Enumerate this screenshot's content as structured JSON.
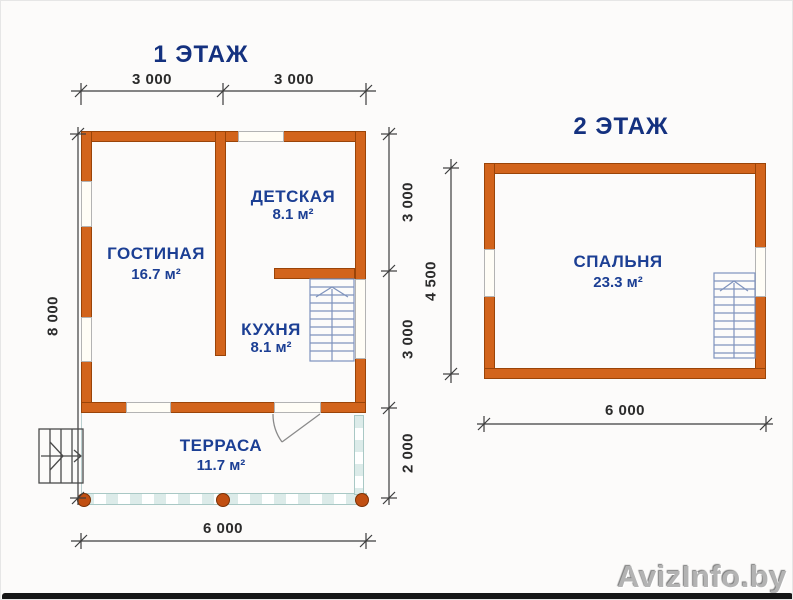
{
  "floor1": {
    "title": "1 ЭТАЖ",
    "rooms": [
      {
        "name": "ГОСТИНАЯ",
        "area": "16.7 м²"
      },
      {
        "name": "ДЕТСКАЯ",
        "area": "8.1 м²"
      },
      {
        "name": "КУХНЯ",
        "area": "8.1 м²"
      },
      {
        "name": "ТЕРРАСА",
        "area": "11.7 м²"
      }
    ],
    "dimensions": {
      "top": [
        "3 000",
        "3 000"
      ],
      "left": "8 000",
      "right": [
        "3 000",
        "3 000",
        "2 000"
      ],
      "bottom": "6 000"
    }
  },
  "floor2": {
    "title": "2 ЭТАЖ",
    "rooms": [
      {
        "name": "СПАЛЬНЯ",
        "area": "23.3 м²"
      }
    ],
    "dimensions": {
      "left": "4 500",
      "bottom": "6 000"
    }
  },
  "watermark": "AvizInfo.by",
  "icons": {
    "stairs_direction": "up-arrow",
    "entrance_direction": "right-arrow",
    "terrace_door": "quarter-arc-swing"
  },
  "colors": {
    "wall": "#d2641c",
    "wall-edge": "#9a4408",
    "window": "#fffdf6",
    "window-edge": "#b3b3b3",
    "rail": "#dcebe9",
    "rail-edge": "#a9c8c5",
    "post": "#c14f12",
    "post-edge": "#7c3206",
    "stairs": "#7f93bd",
    "line": "#3d3d3d",
    "steps": "#4a4a4a",
    "door-line": "#8a8a8a",
    "title": "#14317f",
    "label": "#1c3f94",
    "dim-text": "#2b2b2b",
    "watermark": "#b3b3b3",
    "bar": "#161616",
    "bg": "#fcfbfa"
  }
}
